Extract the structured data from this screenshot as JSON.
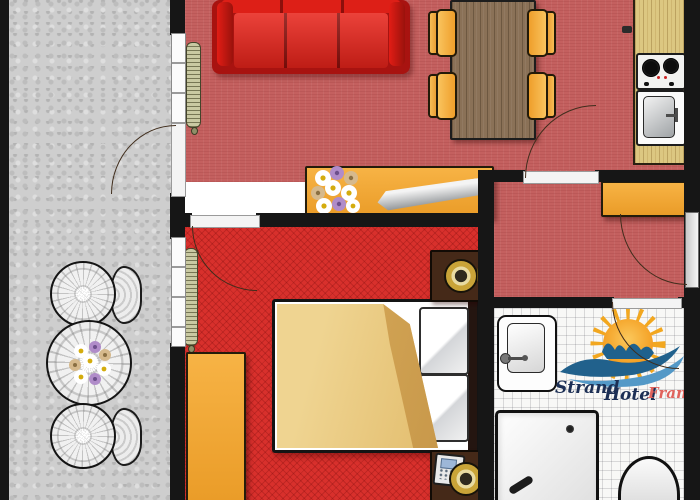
{
  "logo": {
    "word1": "Strand",
    "word2": "Hotel",
    "word3": "Frank"
  },
  "colors": {
    "wall": "#161616",
    "balcony_floor": "#cecece",
    "living_floor": "#c4605f",
    "hallway_floor": "#c4605f",
    "bedroom_floor": "#d8302c",
    "bathroom_floor": "#f8f8f6",
    "counter_wood": "#dcc781",
    "table_wood": "#8a7157",
    "furniture_orange": "#f2a437",
    "couch_red": "#d61c13",
    "blanket_tan": "#e7c57e",
    "nightstand_brown": "#452918",
    "lamp_gold": "#d4b04a",
    "radiator_khaki": "#c9c9a2",
    "sun_orange": "#f2a71f",
    "wave_blue": "#21618c",
    "wave_light_blue": "#5499c7",
    "logo_text_dark": "#1c2f55",
    "logo_text_red": "#e0635c",
    "flower_white": "#ffffff",
    "flower_purple": "#b08cc9",
    "flower_tan": "#d6b98c"
  },
  "furniture_legend": {
    "balcony": [
      "wicker-chair",
      "wicker-table-with-flowers",
      "wicker-chair"
    ],
    "living_room": [
      "red-sofa",
      "dining-table",
      "four-dining-chairs",
      "radiator",
      "sideboard-with-flowers-and-tray"
    ],
    "kitchen": [
      "counter",
      "two-burner-stove",
      "sink"
    ],
    "hallway": [
      "cabinet",
      "entrance-door"
    ],
    "bedroom": [
      "double-bed",
      "two-nightstands",
      "two-lamps",
      "telephone",
      "wardrobe",
      "radiator"
    ],
    "bathroom": [
      "washbasin",
      "shower",
      "toilet"
    ]
  }
}
